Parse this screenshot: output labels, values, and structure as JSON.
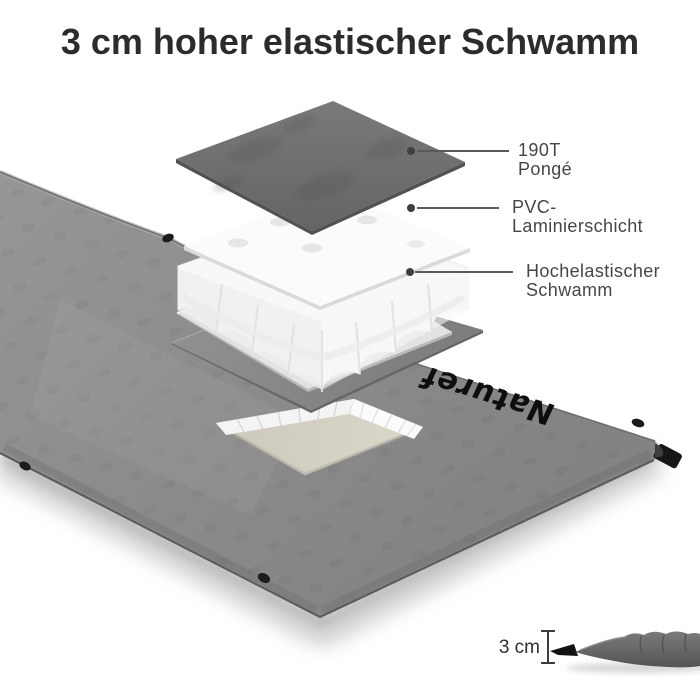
{
  "title": "3 cm hoher elastischer Schwamm",
  "callouts": [
    {
      "label": "190T Pongé"
    },
    {
      "label": "PVC-Laminierschicht"
    },
    {
      "label": "Hochelastischer Schwamm"
    }
  ],
  "mat": {
    "brand_text": "Naturef"
  },
  "measurement": {
    "label": "3 cm"
  },
  "colors": {
    "background": "#ffffff",
    "title_text": "#2c2c2c",
    "label_text": "#464646",
    "callout_line": "#5a5a5a",
    "mat_gray": "#8d8d8d",
    "fabric_gray": "#6d6d6d",
    "foam_white": "#f7f7f7",
    "sheet_light": "#dedede",
    "sheet_dark": "#868686",
    "cutout_floor": "#d7d3c6",
    "valve_black": "#161616"
  }
}
